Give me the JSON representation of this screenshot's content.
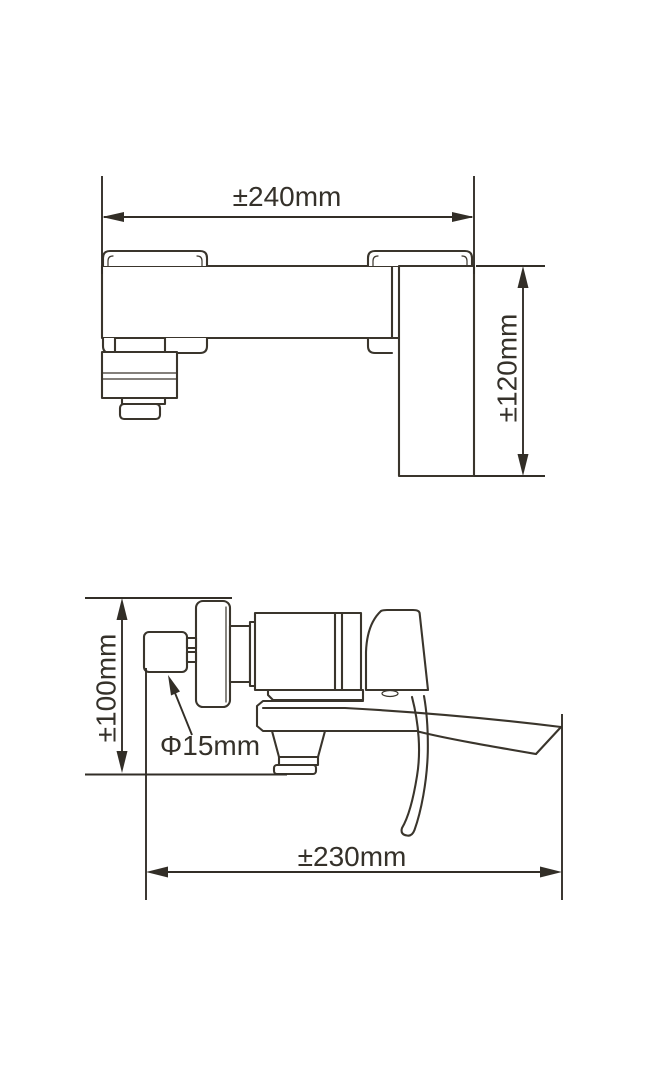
{
  "drawing": {
    "colors": {
      "line": "#3a352c",
      "dimension": "#322e27",
      "text": "#35312a",
      "background": "#ffffff"
    },
    "views": {
      "top": {
        "dims": {
          "width": {
            "label": "±240mm"
          },
          "depth": {
            "label": "±120mm"
          }
        }
      },
      "side": {
        "dims": {
          "height": {
            "label": "±100mm"
          },
          "inlet_diameter": {
            "label": "Φ15mm"
          },
          "length": {
            "label": "±230mm"
          }
        }
      }
    }
  }
}
